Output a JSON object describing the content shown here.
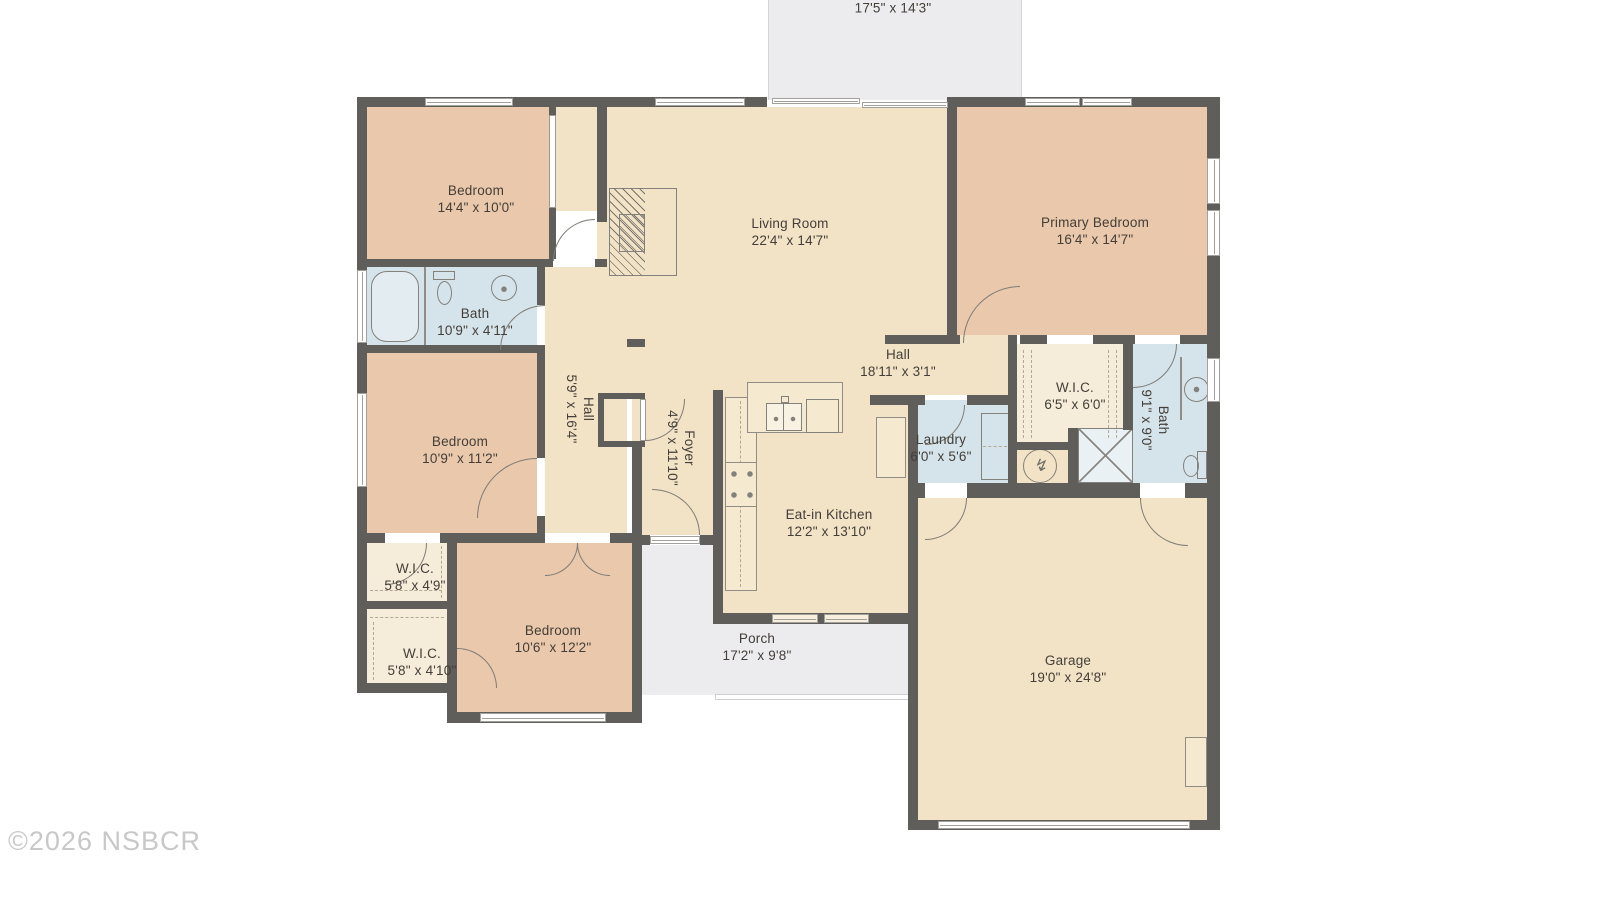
{
  "floorplan": {
    "watermark": "©2026 NSBCR",
    "rooms": {
      "patio": {
        "dims": "17'5\" x 14'3\""
      },
      "bedroom_top_left": {
        "name": "Bedroom",
        "dims": "14'4\" x 10'0\""
      },
      "living_room": {
        "name": "Living Room",
        "dims": "22'4\" x 14'7\""
      },
      "primary_bedroom": {
        "name": "Primary Bedroom",
        "dims": "16'4\" x 14'7\""
      },
      "bath_left": {
        "name": "Bath",
        "dims": "10'9\" x 4'11\""
      },
      "bedroom_mid_left": {
        "name": "Bedroom",
        "dims": "10'9\" x 11'2\""
      },
      "hall_vertical": {
        "name": "Hall",
        "dims": "5'9\" x 16'4\""
      },
      "foyer": {
        "name": "Foyer",
        "dims": "4'9\" x 11'10\""
      },
      "hall_horizontal": {
        "name": "Hall",
        "dims": "18'11\" x 3'1\""
      },
      "wic_center": {
        "name": "W.I.C.",
        "dims": "6'5\" x 6'0\""
      },
      "bath_right": {
        "name": "Bath",
        "dims": "9'1\" x 9'0\""
      },
      "laundry": {
        "name": "Laundry",
        "dims": "6'0\" x 5'6\""
      },
      "eat_in_kitchen": {
        "name": "Eat-in Kitchen",
        "dims": "12'2\" x 13'10\""
      },
      "wic_upper": {
        "name": "W.I.C.",
        "dims": "5'8\" x 4'9\""
      },
      "wic_lower": {
        "name": "W.I.C.",
        "dims": "5'8\" x 4'10\""
      },
      "bedroom_bottom": {
        "name": "Bedroom",
        "dims": "10'6\" x 12'2\""
      },
      "porch": {
        "name": "Porch",
        "dims": "17'2\" x 9'8\""
      },
      "garage": {
        "name": "Garage",
        "dims": "19'0\" x 24'8\""
      }
    },
    "colors": {
      "wall": "#605e5a",
      "bedroom_fill": "#eac8ab",
      "living_fill": "#f2e3c6",
      "closet_fill": "#f5ecd9",
      "bath_fill": "#d5e4ea",
      "outdoor_fill": "#ececee",
      "label_text": "#433e38",
      "watermark_text": "#c8c8c8"
    }
  }
}
